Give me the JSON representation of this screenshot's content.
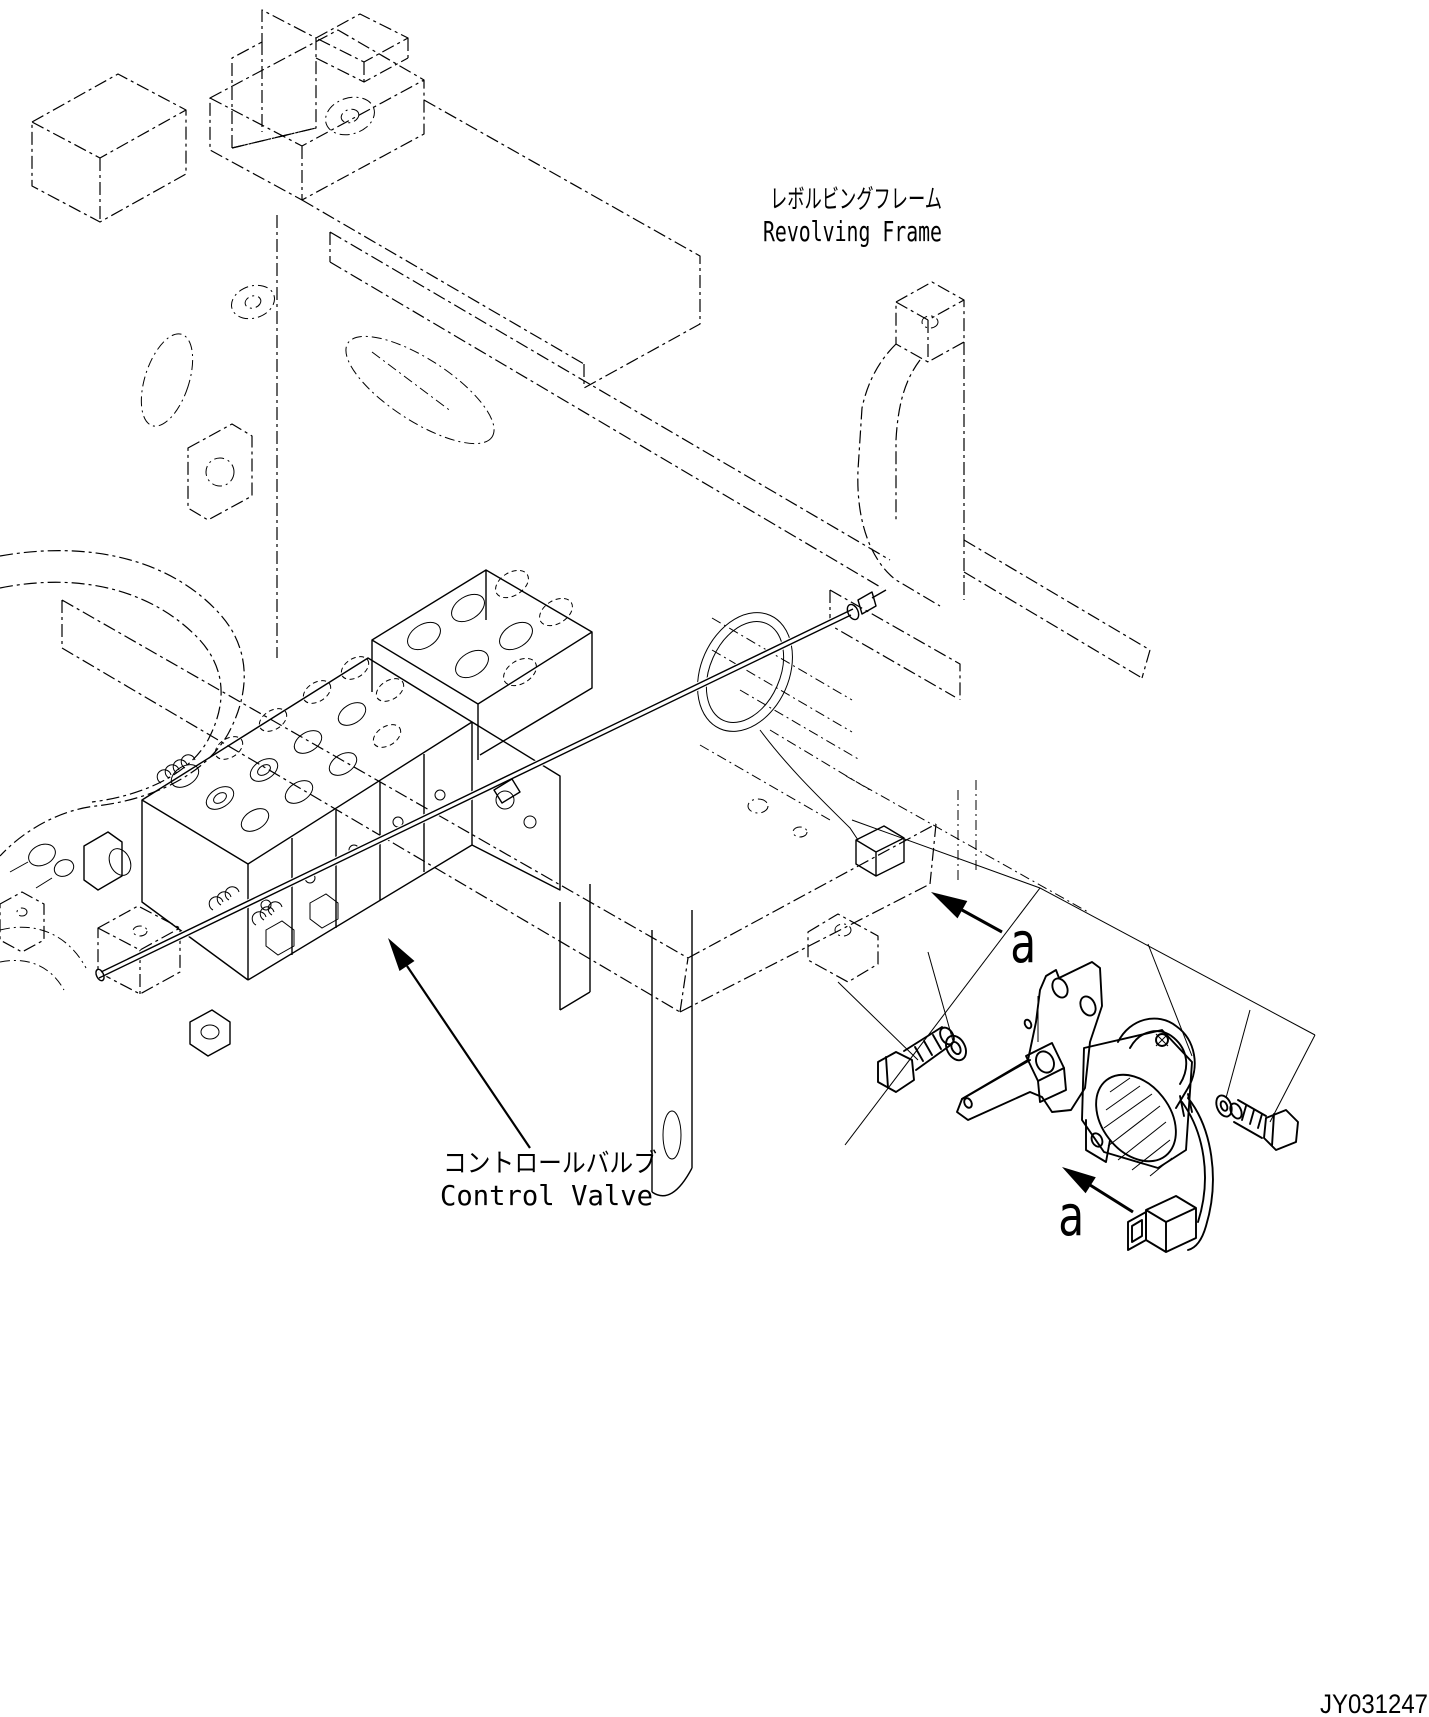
{
  "drawing": {
    "type": "isometric-parts-diagram",
    "background": "#ffffff",
    "ink": "#000000",
    "number": "JY031247"
  },
  "callouts": {
    "revolving_frame": {
      "jp": "レボルビングフレーム",
      "en": "Revolving Frame"
    },
    "control_valve": {
      "jp": "コントロールバルブ",
      "en": "Control Valve"
    },
    "detail_marker_upper": "a",
    "detail_marker_lower": "a"
  }
}
